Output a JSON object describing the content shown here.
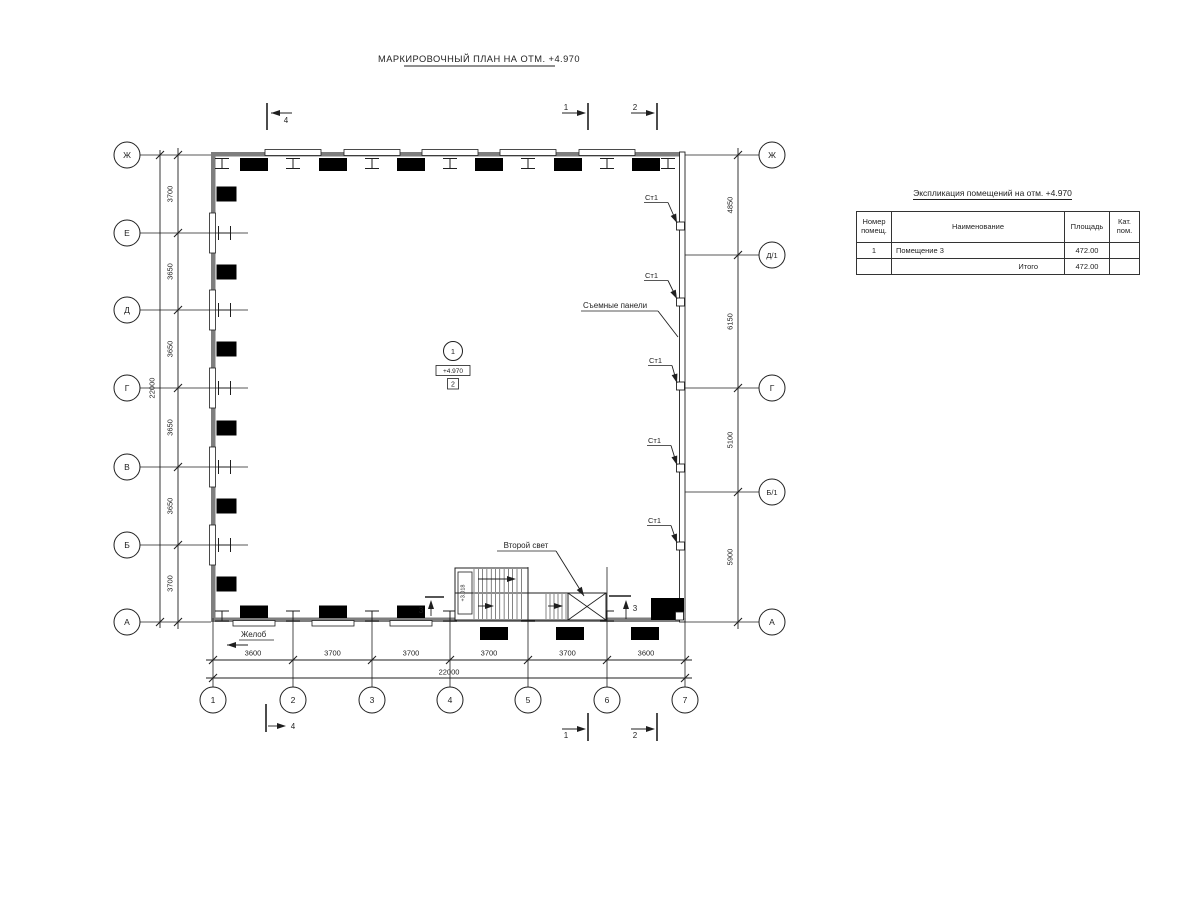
{
  "drawing_title": "МАРКИРОВОЧНЫЙ ПЛАН НА ОТМ. +4.970",
  "axes": {
    "left": [
      "Ж",
      "Е",
      "Д",
      "Г",
      "В",
      "Б",
      "А"
    ],
    "right": [
      "Ж",
      "Д/1",
      "Г",
      "Б/1",
      "А"
    ],
    "bottom": [
      "1",
      "2",
      "3",
      "4",
      "5",
      "6",
      "7"
    ]
  },
  "dimensions": {
    "left": [
      "3700",
      "3650",
      "3650",
      "3650",
      "3650",
      "3700"
    ],
    "left_total": "22000",
    "right": [
      "4850",
      "6150",
      "5100",
      "5900"
    ],
    "bottom": [
      "3600",
      "3700",
      "3700",
      "3700",
      "3700",
      "3600"
    ],
    "bottom_total": "22000"
  },
  "plan_labels": {
    "st1": "Ст1",
    "removable_panels": "Съемные панели",
    "second_light": "Второй свет",
    "gutter": "Желоб",
    "room_number": "1",
    "room_elevation": "+4.970",
    "room_zone": "2",
    "stair_elevation": "+3.018"
  },
  "sections": {
    "s1": "1",
    "s2": "2",
    "s3": "3",
    "s4": "4"
  },
  "table": {
    "title": "Экспликация помещений на отм. +4.970",
    "headers": [
      "Номер помещ.",
      "Наименование",
      "Площадь",
      "Кат. пом."
    ],
    "rows": [
      {
        "num": "1",
        "name": "Помещение 3",
        "area": "472.00",
        "cat": ""
      }
    ],
    "total_label": "Итого",
    "total_area": "472.00"
  },
  "colors": {
    "line": "#1f1f1f",
    "wall_gray": "#7e7e7e",
    "black_fill": "#000000"
  }
}
